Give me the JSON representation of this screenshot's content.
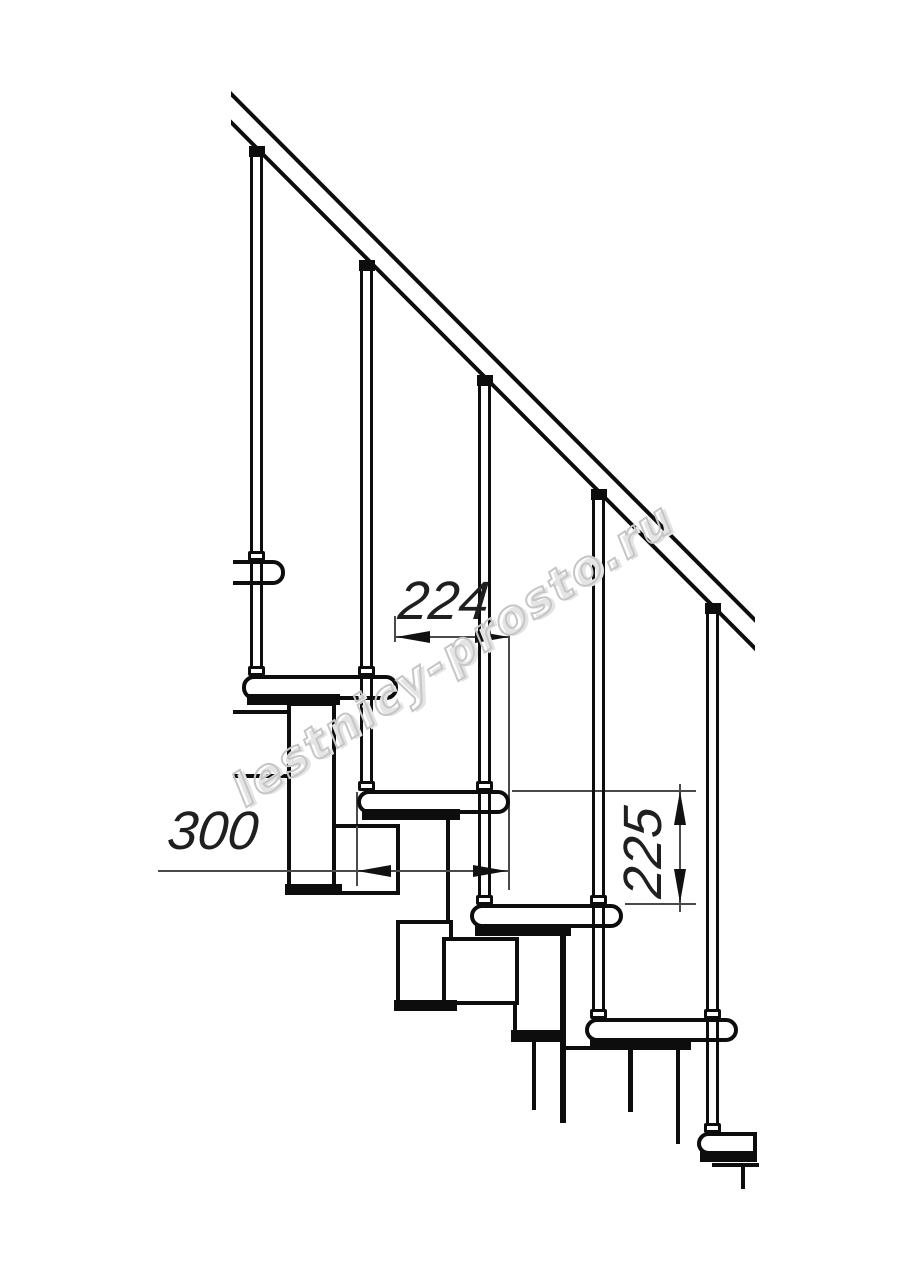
{
  "drawing": {
    "title": "Modular staircase side-view technical drawing",
    "dimensions": {
      "step_run_horizontal": {
        "label": "224",
        "orientation": "horizontal"
      },
      "tread_depth_horizontal": {
        "label": "300",
        "orientation": "horizontal"
      },
      "riser_height_vertical": {
        "label": "225",
        "orientation": "vertical"
      }
    },
    "watermark": {
      "text": "lestnicy-prosto.ru"
    },
    "colors": {
      "object_line": "#0d0d0d",
      "dimension_line": "#4a4a4a",
      "dimension_text": "#1f1f1f",
      "watermark_stroke": "#c6c6c6",
      "background": "#ffffff"
    }
  }
}
